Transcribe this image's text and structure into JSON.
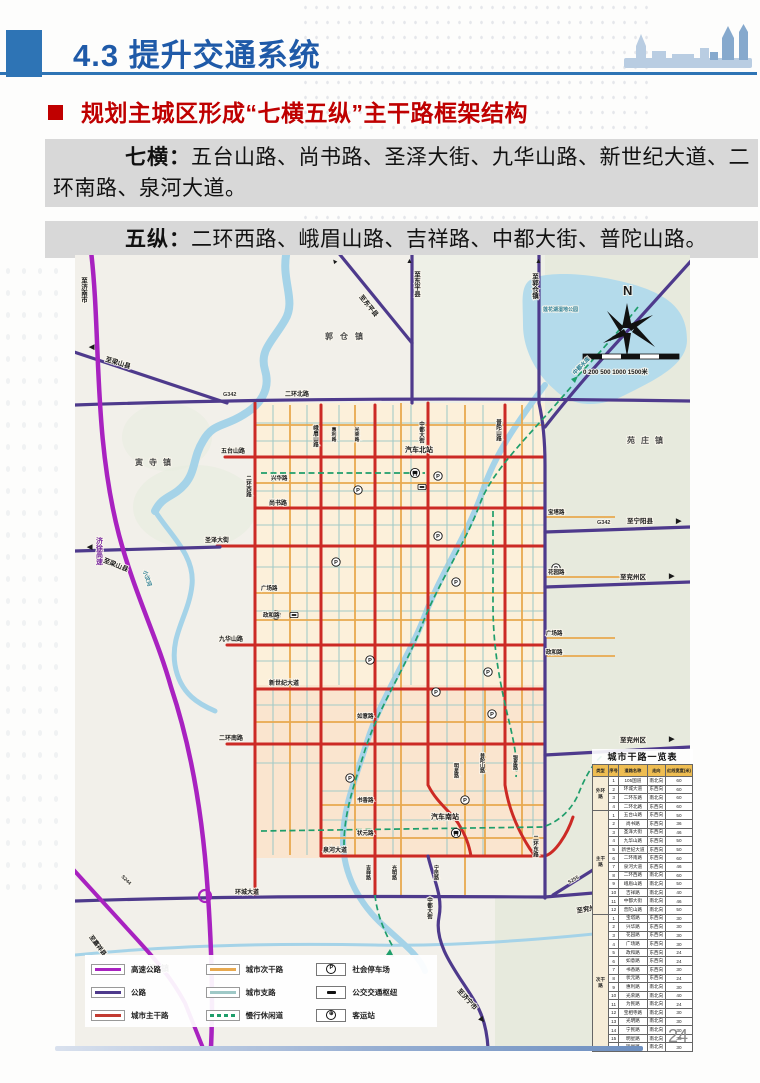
{
  "header": {
    "title": "4.3 提升交通系统",
    "heading": "规划主城区形成“七横五纵”主干路框架结构"
  },
  "body": {
    "p1_label": "七横：",
    "p1_text": "五台山路、尚书路、圣泽大街、九华山路、新世纪大道、二环南路、泉河大道。",
    "p2_label": "五纵：",
    "p2_text": "二环西路、峨眉山路、吉祥路、中都大街、普陀山路。"
  },
  "footer": {
    "page_number": "24"
  },
  "colors": {
    "accent_blue": "#2e74b5",
    "title_blue": "#1f5aa8",
    "heading_red": "#bf0000",
    "expressway": "#a822c0",
    "highway": "#4e3a8c",
    "arterial": "#cc2a25",
    "secondary": "#e8a94f",
    "branch": "#9fc9c7",
    "leisure": "#1f9e6b"
  },
  "map": {
    "labels": [
      {
        "t": "至济南市",
        "x": 8,
        "y": 22,
        "c": "v dir"
      },
      {
        "t": "▲",
        "x": 258,
        "y": 10,
        "r": -38,
        "c": "arr"
      },
      {
        "t": "至东平县",
        "x": 284,
        "y": 42,
        "r": 51,
        "c": "dir"
      },
      {
        "t": "▲",
        "x": 331,
        "y": 8,
        "c": "arr"
      },
      {
        "t": "至东平县",
        "x": 341,
        "y": 16,
        "c": "v dir"
      },
      {
        "t": "▲",
        "x": 460,
        "y": 8,
        "c": "arr"
      },
      {
        "t": "至郭仓镇",
        "x": 459,
        "y": 18,
        "c": "v dir"
      },
      {
        "t": "郭仓镇",
        "x": 250,
        "y": 84,
        "c": "town",
        "ls": 7
      },
      {
        "t": "莲花湖湿地公园",
        "x": 468,
        "y": 56,
        "c": "water",
        "s": 5
      },
      {
        "t": "中都水库",
        "x": 500,
        "y": 120,
        "r": -46,
        "c": "water",
        "s": 5.5
      },
      {
        "t": "N",
        "x": 548,
        "y": 40,
        "c": "north",
        "s": 13
      },
      {
        "t": "0 200 500 1000 1500米",
        "x": 508,
        "y": 119,
        "c": "scale",
        "s": 6.2
      },
      {
        "t": "苑庄镇",
        "x": 552,
        "y": 188,
        "c": "town",
        "ls": 6
      },
      {
        "t": "寅寺镇",
        "x": 60,
        "y": 210,
        "c": "town",
        "ls": 6
      },
      {
        "t": "◀",
        "x": 14,
        "y": 94,
        "c": "arr"
      },
      {
        "t": "至梁山县",
        "x": 30,
        "y": 106,
        "r": 17,
        "c": "dir"
      },
      {
        "t": "G342",
        "x": 148,
        "y": 141,
        "c": "roadnum",
        "s": 5.5
      },
      {
        "t": "二环北路",
        "x": 210,
        "y": 141,
        "c": "road"
      },
      {
        "t": "小汶河",
        "x": 68,
        "y": 316,
        "r": 72,
        "c": "water",
        "s": 5.5
      },
      {
        "t": "济徐高速",
        "x": 24,
        "y": 282,
        "c": "v hw"
      },
      {
        "t": "◀",
        "x": 12,
        "y": 294,
        "c": "arr"
      },
      {
        "t": "至梁山县",
        "x": 28,
        "y": 307,
        "r": 22,
        "c": "dir"
      },
      {
        "t": "五台山路",
        "x": 146,
        "y": 198,
        "c": "road"
      },
      {
        "t": "尚书路",
        "x": 194,
        "y": 250,
        "c": "road"
      },
      {
        "t": "圣泽大街",
        "x": 130,
        "y": 287,
        "c": "road"
      },
      {
        "t": "九华山路",
        "x": 144,
        "y": 386,
        "c": "road"
      },
      {
        "t": "新世纪大道",
        "x": 194,
        "y": 430,
        "c": "road"
      },
      {
        "t": "二环南路",
        "x": 144,
        "y": 485,
        "c": "road"
      },
      {
        "t": "泉河大道",
        "x": 248,
        "y": 597,
        "c": "road"
      },
      {
        "t": "环城大道",
        "x": 160,
        "y": 639,
        "c": "road"
      },
      {
        "t": "兴华路",
        "x": 196,
        "y": 225,
        "c": "road",
        "s": 5.5
      },
      {
        "t": "广场路",
        "x": 186,
        "y": 335,
        "c": "road",
        "s": 5.5
      },
      {
        "t": "政和路",
        "x": 188,
        "y": 362,
        "c": "road",
        "s": 5.5
      },
      {
        "t": "如意路",
        "x": 282,
        "y": 463,
        "c": "road",
        "s": 5.5
      },
      {
        "t": "书香路",
        "x": 282,
        "y": 547,
        "c": "road",
        "s": 5.5
      },
      {
        "t": "状元路",
        "x": 282,
        "y": 580,
        "c": "road",
        "s": 5.5
      },
      {
        "t": "宝塔路",
        "x": 473,
        "y": 259,
        "c": "road",
        "s": 5.5
      },
      {
        "t": "花园路",
        "x": 473,
        "y": 319,
        "c": "road",
        "s": 5.5
      },
      {
        "t": "广场路",
        "x": 471,
        "y": 380,
        "c": "road",
        "s": 5.5
      },
      {
        "t": "政和路",
        "x": 471,
        "y": 399,
        "c": "road",
        "s": 5.5
      },
      {
        "t": "二环西路",
        "x": 173,
        "y": 220,
        "c": "v road",
        "s": 5.5
      },
      {
        "t": "峨眉山路",
        "x": 240,
        "y": 170,
        "c": "v road",
        "s": 5.5
      },
      {
        "t": "惠利路",
        "x": 258,
        "y": 172,
        "c": "v road",
        "s": 4.8
      },
      {
        "t": "光荣路",
        "x": 281,
        "y": 172,
        "c": "v road",
        "s": 4.8
      },
      {
        "t": "中都大街",
        "x": 346,
        "y": 166,
        "c": "v road",
        "s": 5.5
      },
      {
        "t": "普陀山路",
        "x": 423,
        "y": 164,
        "c": "v road",
        "s": 5.5
      },
      {
        "t": "吉祥路",
        "x": 293,
        "y": 610,
        "c": "v road",
        "s": 5
      },
      {
        "t": "光明路",
        "x": 319,
        "y": 610,
        "c": "v road",
        "s": 5
      },
      {
        "t": "宁民路",
        "x": 361,
        "y": 610,
        "c": "v road",
        "s": 5
      },
      {
        "t": "明星路",
        "x": 381,
        "y": 508,
        "c": "v road",
        "s": 5
      },
      {
        "t": "普陀山路",
        "x": 407,
        "y": 498,
        "c": "v road",
        "s": 5
      },
      {
        "t": "银星路",
        "x": 440,
        "y": 500,
        "c": "v road",
        "s": 5
      },
      {
        "t": "二环东路",
        "x": 460,
        "y": 580,
        "c": "v road",
        "s": 5.5
      },
      {
        "t": "汽车北站",
        "x": 330,
        "y": 197,
        "c": "station"
      },
      {
        "t": "汽车南站",
        "x": 356,
        "y": 564,
        "c": "station"
      },
      {
        "t": "中都大街",
        "x": 354,
        "y": 642,
        "c": "v road",
        "s": 5.5
      },
      {
        "t": "至济宁市",
        "x": 382,
        "y": 736,
        "r": 48,
        "c": "dir"
      },
      {
        "t": "▶",
        "x": 404,
        "y": 764,
        "r": 48,
        "c": "arr"
      },
      {
        "t": "至嘉祥县",
        "x": 14,
        "y": 682,
        "r": 53,
        "c": "dir",
        "s": 6
      },
      {
        "t": "S244",
        "x": 46,
        "y": 622,
        "r": 44,
        "c": "roadnum",
        "s": 5
      },
      {
        "t": "次邱镇",
        "x": 58,
        "y": 716,
        "c": "town",
        "ls": 6
      },
      {
        "t": "G342",
        "x": 522,
        "y": 269,
        "c": "roadnum",
        "s": 5.5
      },
      {
        "t": "至宁阳县",
        "x": 552,
        "y": 268,
        "c": "dir"
      },
      {
        "t": "▶",
        "x": 601,
        "y": 268,
        "c": "arr"
      },
      {
        "t": "至兖州区",
        "x": 545,
        "y": 324,
        "c": "dir"
      },
      {
        "t": "▶",
        "x": 594,
        "y": 323,
        "c": "arr"
      },
      {
        "t": "至兖州区",
        "x": 545,
        "y": 487,
        "c": "dir"
      },
      {
        "t": "▶",
        "x": 594,
        "y": 486,
        "c": "arr"
      },
      {
        "t": "至兖州区",
        "x": 502,
        "y": 658,
        "r": -10,
        "c": "dir"
      },
      {
        "t": "▶",
        "x": 552,
        "y": 650,
        "r": -10,
        "c": "arr"
      },
      {
        "t": "S255",
        "x": 494,
        "y": 629,
        "r": -30,
        "c": "roadnum",
        "s": 5
      }
    ],
    "icons": {
      "p": [
        [
          283,
          235
        ],
        [
          363,
          221
        ],
        [
          363,
          281
        ],
        [
          261,
          307
        ],
        [
          381,
          327
        ],
        [
          481,
          313
        ],
        [
          201,
          360
        ],
        [
          295,
          405
        ],
        [
          413,
          417
        ],
        [
          361,
          437
        ],
        [
          417,
          459
        ],
        [
          275,
          523
        ],
        [
          390,
          545
        ]
      ],
      "hub": [
        [
          347,
          232
        ],
        [
          219,
          360
        ]
      ],
      "bus": [
        [
          340,
          218
        ],
        [
          381,
          578
        ]
      ]
    },
    "legend": {
      "col1": [
        {
          "label": "高速公路",
          "color": "#a822c0"
        },
        {
          "label": "公路",
          "color": "#4e3a8c"
        },
        {
          "label": "城市主干路",
          "color": "#c23b32"
        }
      ],
      "col2": [
        {
          "label": "城市次干路",
          "color": "#e8a94f"
        },
        {
          "label": "城市支路",
          "color": "#9fc9c7"
        },
        {
          "label": "慢行休闲道",
          "color": "#1f9e6b",
          "dash": true
        }
      ],
      "col3": [
        {
          "label": "社会停车场",
          "icon": "parking"
        },
        {
          "label": "公交交通枢纽",
          "icon": "hub"
        },
        {
          "label": "客运站",
          "icon": "coach"
        }
      ]
    },
    "table": {
      "title": "城市干路一览表",
      "headers": [
        "类型",
        "序号",
        "道路名称",
        "走向",
        "红线宽度(米)"
      ],
      "groups": [
        {
          "name": "外环路",
          "rows": [
            [
              "1",
              "105国道",
              "南北向",
              "60"
            ],
            [
              "2",
              "环城大道",
              "东西向",
              "60"
            ],
            [
              "3",
              "二环东路",
              "南北向",
              "60"
            ],
            [
              "4",
              "二环北路",
              "东西向",
              "60"
            ]
          ]
        },
        {
          "name": "主干路",
          "rows": [
            [
              "1",
              "五台山路",
              "东西向",
              "50"
            ],
            [
              "2",
              "尚书路",
              "东西向",
              "36"
            ],
            [
              "3",
              "圣泽大街",
              "东西向",
              "46"
            ],
            [
              "4",
              "九华山路",
              "东西向",
              "50"
            ],
            [
              "5",
              "新世纪大道",
              "东西向",
              "50"
            ],
            [
              "6",
              "二环南路",
              "东西向",
              "60"
            ],
            [
              "7",
              "泉河大道",
              "东西向",
              "46"
            ],
            [
              "8",
              "二环西路",
              "南北向",
              "60"
            ],
            [
              "9",
              "峨眉山路",
              "南北向",
              "50"
            ],
            [
              "10",
              "吉祥路",
              "南北向",
              "40"
            ],
            [
              "11",
              "中都大街",
              "南北向",
              "46"
            ],
            [
              "12",
              "普陀山路",
              "南北向",
              "50"
            ]
          ]
        },
        {
          "name": "次干路",
          "rows": [
            [
              "1",
              "宝塔路",
              "东西向",
              "30"
            ],
            [
              "2",
              "兴华路",
              "东西向",
              "30"
            ],
            [
              "3",
              "花园路",
              "东西向",
              "30"
            ],
            [
              "4",
              "广场路",
              "东西向",
              "30"
            ],
            [
              "5",
              "政和路",
              "东西向",
              "24"
            ],
            [
              "6",
              "如意路",
              "东西向",
              "24"
            ],
            [
              "7",
              "书香路",
              "东西向",
              "30"
            ],
            [
              "8",
              "状元路",
              "东西向",
              "24"
            ],
            [
              "9",
              "惠利路",
              "南北向",
              "30"
            ],
            [
              "10",
              "光荣路",
              "南北向",
              "40"
            ],
            [
              "11",
              "为民路",
              "南北向",
              "24"
            ],
            [
              "12",
              "宝相寺路",
              "南北向",
              "30"
            ],
            [
              "13",
              "光明路",
              "南北向",
              "30"
            ],
            [
              "14",
              "宁民路",
              "南北向",
              "30"
            ],
            [
              "15",
              "明星路",
              "南北向",
              "30"
            ],
            [
              "16",
              "银星路",
              "南北向",
              "30"
            ]
          ]
        }
      ]
    }
  }
}
